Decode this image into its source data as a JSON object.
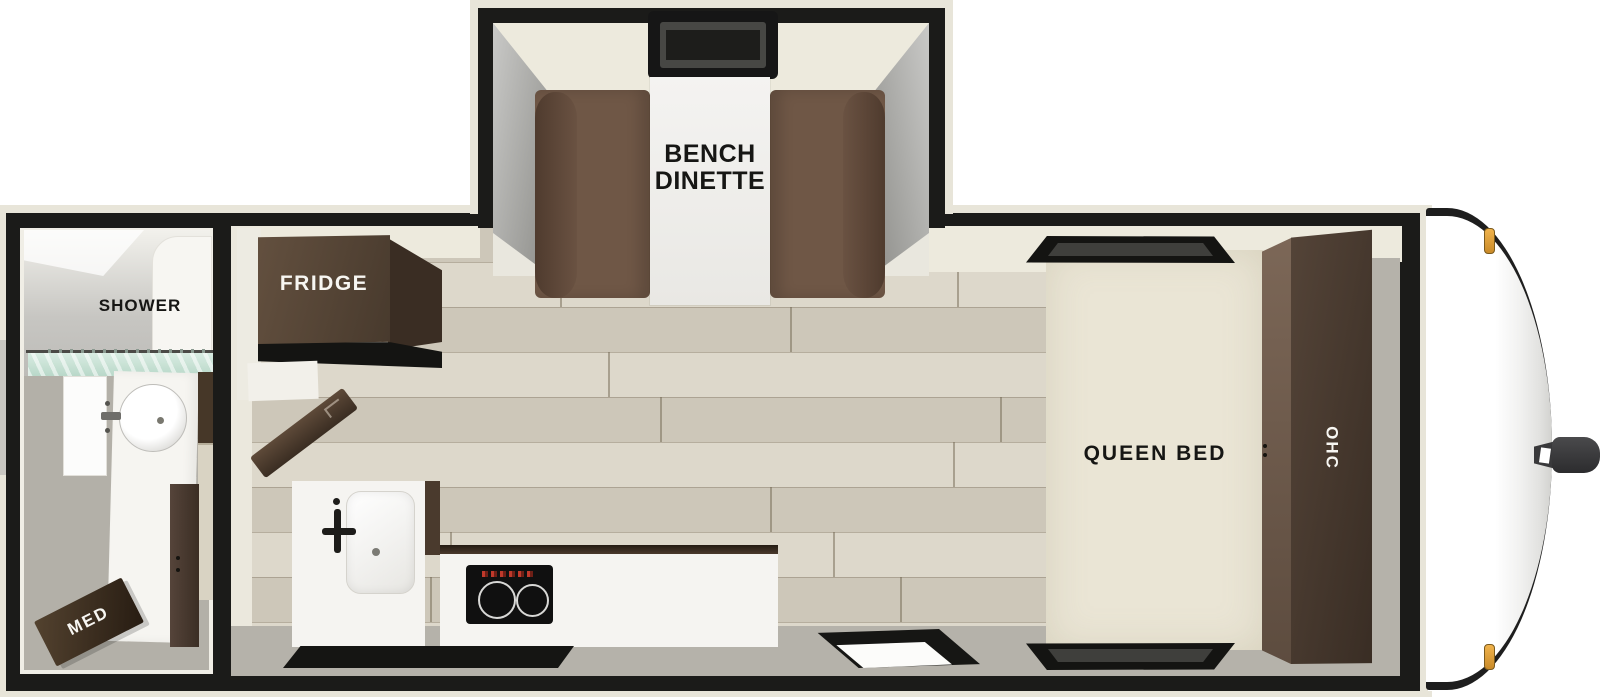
{
  "floorplan": {
    "type": "travel-trailer top-down floor plan",
    "labels": {
      "dinette": "BENCH\nDINETTE",
      "fridge": "FRIDGE",
      "queen_bed": "QUEEN BED",
      "ohc": "OHC",
      "shower": "SHOWER",
      "med": "MED"
    },
    "rooms": [
      {
        "name": "bench dinette slide-out",
        "position": "top center"
      },
      {
        "name": "bathroom with shower and medicine cabinet",
        "position": "left rear"
      },
      {
        "name": "kitchen with fridge, sink, cooktop",
        "position": "center"
      },
      {
        "name": "bedroom with queen bed and overhead cabinet",
        "position": "right front"
      }
    ],
    "fixtures": [
      "slide-out window",
      "dinette table",
      "dinette benches",
      "refrigerator",
      "entry door",
      "kitchen sink",
      "two-burner cooktop",
      "kitchen window",
      "main entry door",
      "queen bed",
      "bed head window",
      "bed foot window",
      "overhead cabinet",
      "shower",
      "shower curtain",
      "bathroom vanity sink",
      "bathroom door",
      "medicine cabinet",
      "front cap",
      "hitch coupler",
      "marker lights"
    ]
  },
  "colors": {
    "wall_black": "#1b1b19",
    "exterior_trim_cream": "#e8e5d9",
    "interior_wall_cream": "#edeadd",
    "wood_floor": "#d6d0c1",
    "walkway_gray": "#b5b2aa",
    "furniture_dark_brown": "#483a2d",
    "bench_brown": "#6f5746",
    "bed_cream": "#eae5d5",
    "counter_white": "#f5f4f1",
    "shower_glass_teal": "#c7e0d3",
    "marker_light_amber": "#e8a33d"
  }
}
